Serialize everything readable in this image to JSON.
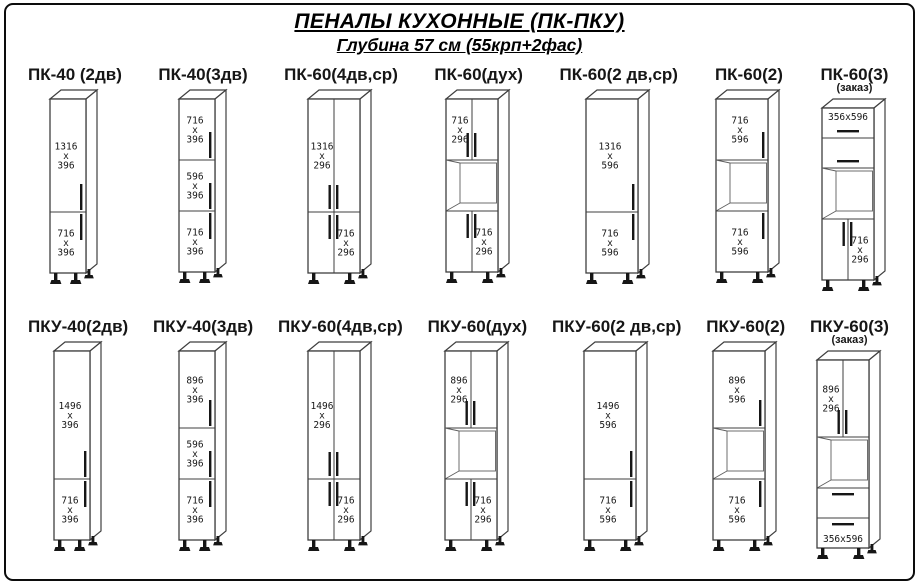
{
  "header": {
    "title": "ПЕНАЛЫ  КУХОННЫЕ (ПК-ПКУ)",
    "subtitle": "Глубина 57 см (55крп+2фас)"
  },
  "rows": [
    {
      "name": "ПК",
      "cabinets": [
        {
          "title": "ПК-40 (2дв)",
          "note": "",
          "width_mm": 400,
          "sections": [
            {
              "kind": "door",
              "h_mm": 1316,
              "label": [
                "1316",
                "x",
                "396"
              ],
              "handle": "right-bottom",
              "label_pos": "center"
            },
            {
              "kind": "door",
              "h_mm": 716,
              "label": [
                "716",
                "x",
                "396"
              ],
              "handle": "right-top",
              "label_pos": "center"
            }
          ]
        },
        {
          "title": "ПК-40(3дв)",
          "note": "",
          "width_mm": 400,
          "sections": [
            {
              "kind": "door",
              "h_mm": 716,
              "label": [
                "716",
                "x",
                "396"
              ],
              "handle": "right-bottom",
              "label_pos": "center"
            },
            {
              "kind": "door",
              "h_mm": 596,
              "label": [
                "596",
                "x",
                "396"
              ],
              "handle": "right-bottom",
              "label_pos": "center"
            },
            {
              "kind": "door",
              "h_mm": 716,
              "label": [
                "716",
                "x",
                "396"
              ],
              "handle": "right-top",
              "label_pos": "center"
            }
          ]
        },
        {
          "title": "ПК-60(4дв,ср)",
          "note": "",
          "width_mm": 600,
          "sections": [
            {
              "kind": "door2",
              "h_mm": 1316,
              "label": [
                "1316",
                "x",
                "296"
              ],
              "handle": "pair-bottom",
              "label_pos": "left"
            },
            {
              "kind": "door2",
              "h_mm": 716,
              "label": [
                "716",
                "x",
                "296"
              ],
              "handle": "pair-top",
              "label_pos": "right"
            }
          ]
        },
        {
          "title": "ПК-60(дух)",
          "note": "",
          "width_mm": 600,
          "sections": [
            {
              "kind": "door2",
              "h_mm": 716,
              "label": [
                "716",
                "x",
                "296"
              ],
              "handle": "pair-bottom",
              "label_pos": "left"
            },
            {
              "kind": "niche",
              "h_mm": 596,
              "label": [],
              "handle": "",
              "label_pos": "center"
            },
            {
              "kind": "door2",
              "h_mm": 716,
              "label": [
                "716",
                "x",
                "296"
              ],
              "handle": "pair-top",
              "label_pos": "right"
            }
          ]
        },
        {
          "title": "ПК-60(2 дв,ср)",
          "note": "",
          "width_mm": 600,
          "sections": [
            {
              "kind": "door",
              "h_mm": 1316,
              "label": [
                "1316",
                "x",
                "596"
              ],
              "handle": "right-bottom",
              "label_pos": "center"
            },
            {
              "kind": "door",
              "h_mm": 716,
              "label": [
                "716",
                "x",
                "596"
              ],
              "handle": "right-top",
              "label_pos": "center"
            }
          ]
        },
        {
          "title": "ПК-60(2)",
          "note": "",
          "width_mm": 600,
          "sections": [
            {
              "kind": "door",
              "h_mm": 716,
              "label": [
                "716",
                "x",
                "596"
              ],
              "handle": "right-bottom",
              "label_pos": "center"
            },
            {
              "kind": "niche",
              "h_mm": 596,
              "label": [],
              "handle": "",
              "label_pos": "center"
            },
            {
              "kind": "door",
              "h_mm": 716,
              "label": [
                "716",
                "x",
                "596"
              ],
              "handle": "right-top",
              "label_pos": "center"
            }
          ]
        },
        {
          "title": "ПК-60(3)",
          "note": "(заказ)",
          "width_mm": 600,
          "sections": [
            {
              "kind": "drawer",
              "h_mm": 356,
              "label": [
                "356x596"
              ],
              "handle": "drawer-bottom",
              "label_pos": "center"
            },
            {
              "kind": "drawer",
              "h_mm": 356,
              "label": [],
              "handle": "drawer-bottom",
              "label_pos": "center"
            },
            {
              "kind": "niche",
              "h_mm": 596,
              "label": [],
              "handle": "",
              "label_pos": "center"
            },
            {
              "kind": "door2",
              "h_mm": 716,
              "label": [
                "716",
                "x",
                "296"
              ],
              "handle": "pair-top",
              "label_pos": "right"
            }
          ]
        }
      ]
    },
    {
      "name": "ПКУ",
      "cabinets": [
        {
          "title": "ПКУ-40(2дв)",
          "note": "",
          "width_mm": 400,
          "sections": [
            {
              "kind": "door",
              "h_mm": 1496,
              "label": [
                "1496",
                "x",
                "396"
              ],
              "handle": "right-bottom",
              "label_pos": "center"
            },
            {
              "kind": "door",
              "h_mm": 716,
              "label": [
                "716",
                "x",
                "396"
              ],
              "handle": "right-top",
              "label_pos": "center"
            }
          ]
        },
        {
          "title": "ПКУ-40(3дв)",
          "note": "",
          "width_mm": 400,
          "sections": [
            {
              "kind": "door",
              "h_mm": 896,
              "label": [
                "896",
                "x",
                "396"
              ],
              "handle": "right-bottom",
              "label_pos": "center"
            },
            {
              "kind": "door",
              "h_mm": 596,
              "label": [
                "596",
                "x",
                "396"
              ],
              "handle": "right-bottom",
              "label_pos": "center"
            },
            {
              "kind": "door",
              "h_mm": 716,
              "label": [
                "716",
                "x",
                "396"
              ],
              "handle": "right-top",
              "label_pos": "center"
            }
          ]
        },
        {
          "title": "ПКУ-60(4дв,ср)",
          "note": "",
          "width_mm": 600,
          "sections": [
            {
              "kind": "door2",
              "h_mm": 1496,
              "label": [
                "1496",
                "x",
                "296"
              ],
              "handle": "pair-bottom",
              "label_pos": "left"
            },
            {
              "kind": "door2",
              "h_mm": 716,
              "label": [
                "716",
                "x",
                "296"
              ],
              "handle": "pair-top",
              "label_pos": "right"
            }
          ]
        },
        {
          "title": "ПКУ-60(дух)",
          "note": "",
          "width_mm": 600,
          "sections": [
            {
              "kind": "door2",
              "h_mm": 896,
              "label": [
                "896",
                "x",
                "296"
              ],
              "handle": "pair-bottom",
              "label_pos": "left"
            },
            {
              "kind": "niche",
              "h_mm": 596,
              "label": [],
              "handle": "",
              "label_pos": "center"
            },
            {
              "kind": "door2",
              "h_mm": 716,
              "label": [
                "716",
                "x",
                "296"
              ],
              "handle": "pair-top",
              "label_pos": "right"
            }
          ]
        },
        {
          "title": "ПКУ-60(2 дв,ср)",
          "note": "",
          "width_mm": 600,
          "sections": [
            {
              "kind": "door",
              "h_mm": 1496,
              "label": [
                "1496",
                "x",
                "596"
              ],
              "handle": "right-bottom",
              "label_pos": "center"
            },
            {
              "kind": "door",
              "h_mm": 716,
              "label": [
                "716",
                "x",
                "596"
              ],
              "handle": "right-top",
              "label_pos": "center"
            }
          ]
        },
        {
          "title": "ПКУ-60(2)",
          "note": "",
          "width_mm": 600,
          "sections": [
            {
              "kind": "door",
              "h_mm": 896,
              "label": [
                "896",
                "x",
                "596"
              ],
              "handle": "right-bottom",
              "label_pos": "center"
            },
            {
              "kind": "niche",
              "h_mm": 596,
              "label": [],
              "handle": "",
              "label_pos": "center"
            },
            {
              "kind": "door",
              "h_mm": 716,
              "label": [
                "716",
                "x",
                "596"
              ],
              "handle": "right-top",
              "label_pos": "center"
            }
          ]
        },
        {
          "title": "ПКУ-60(3)",
          "note": "(заказ)",
          "width_mm": 600,
          "sections": [
            {
              "kind": "door2",
              "h_mm": 896,
              "label": [
                "896",
                "x",
                "296"
              ],
              "handle": "pair-bottom",
              "label_pos": "left"
            },
            {
              "kind": "niche",
              "h_mm": 596,
              "label": [],
              "handle": "",
              "label_pos": "center"
            },
            {
              "kind": "drawer",
              "h_mm": 356,
              "label": [],
              "handle": "drawer-top",
              "label_pos": "center"
            },
            {
              "kind": "drawer",
              "h_mm": 356,
              "label": [
                "356x596"
              ],
              "handle": "drawer-top",
              "label_pos": "center"
            }
          ]
        }
      ]
    }
  ]
}
